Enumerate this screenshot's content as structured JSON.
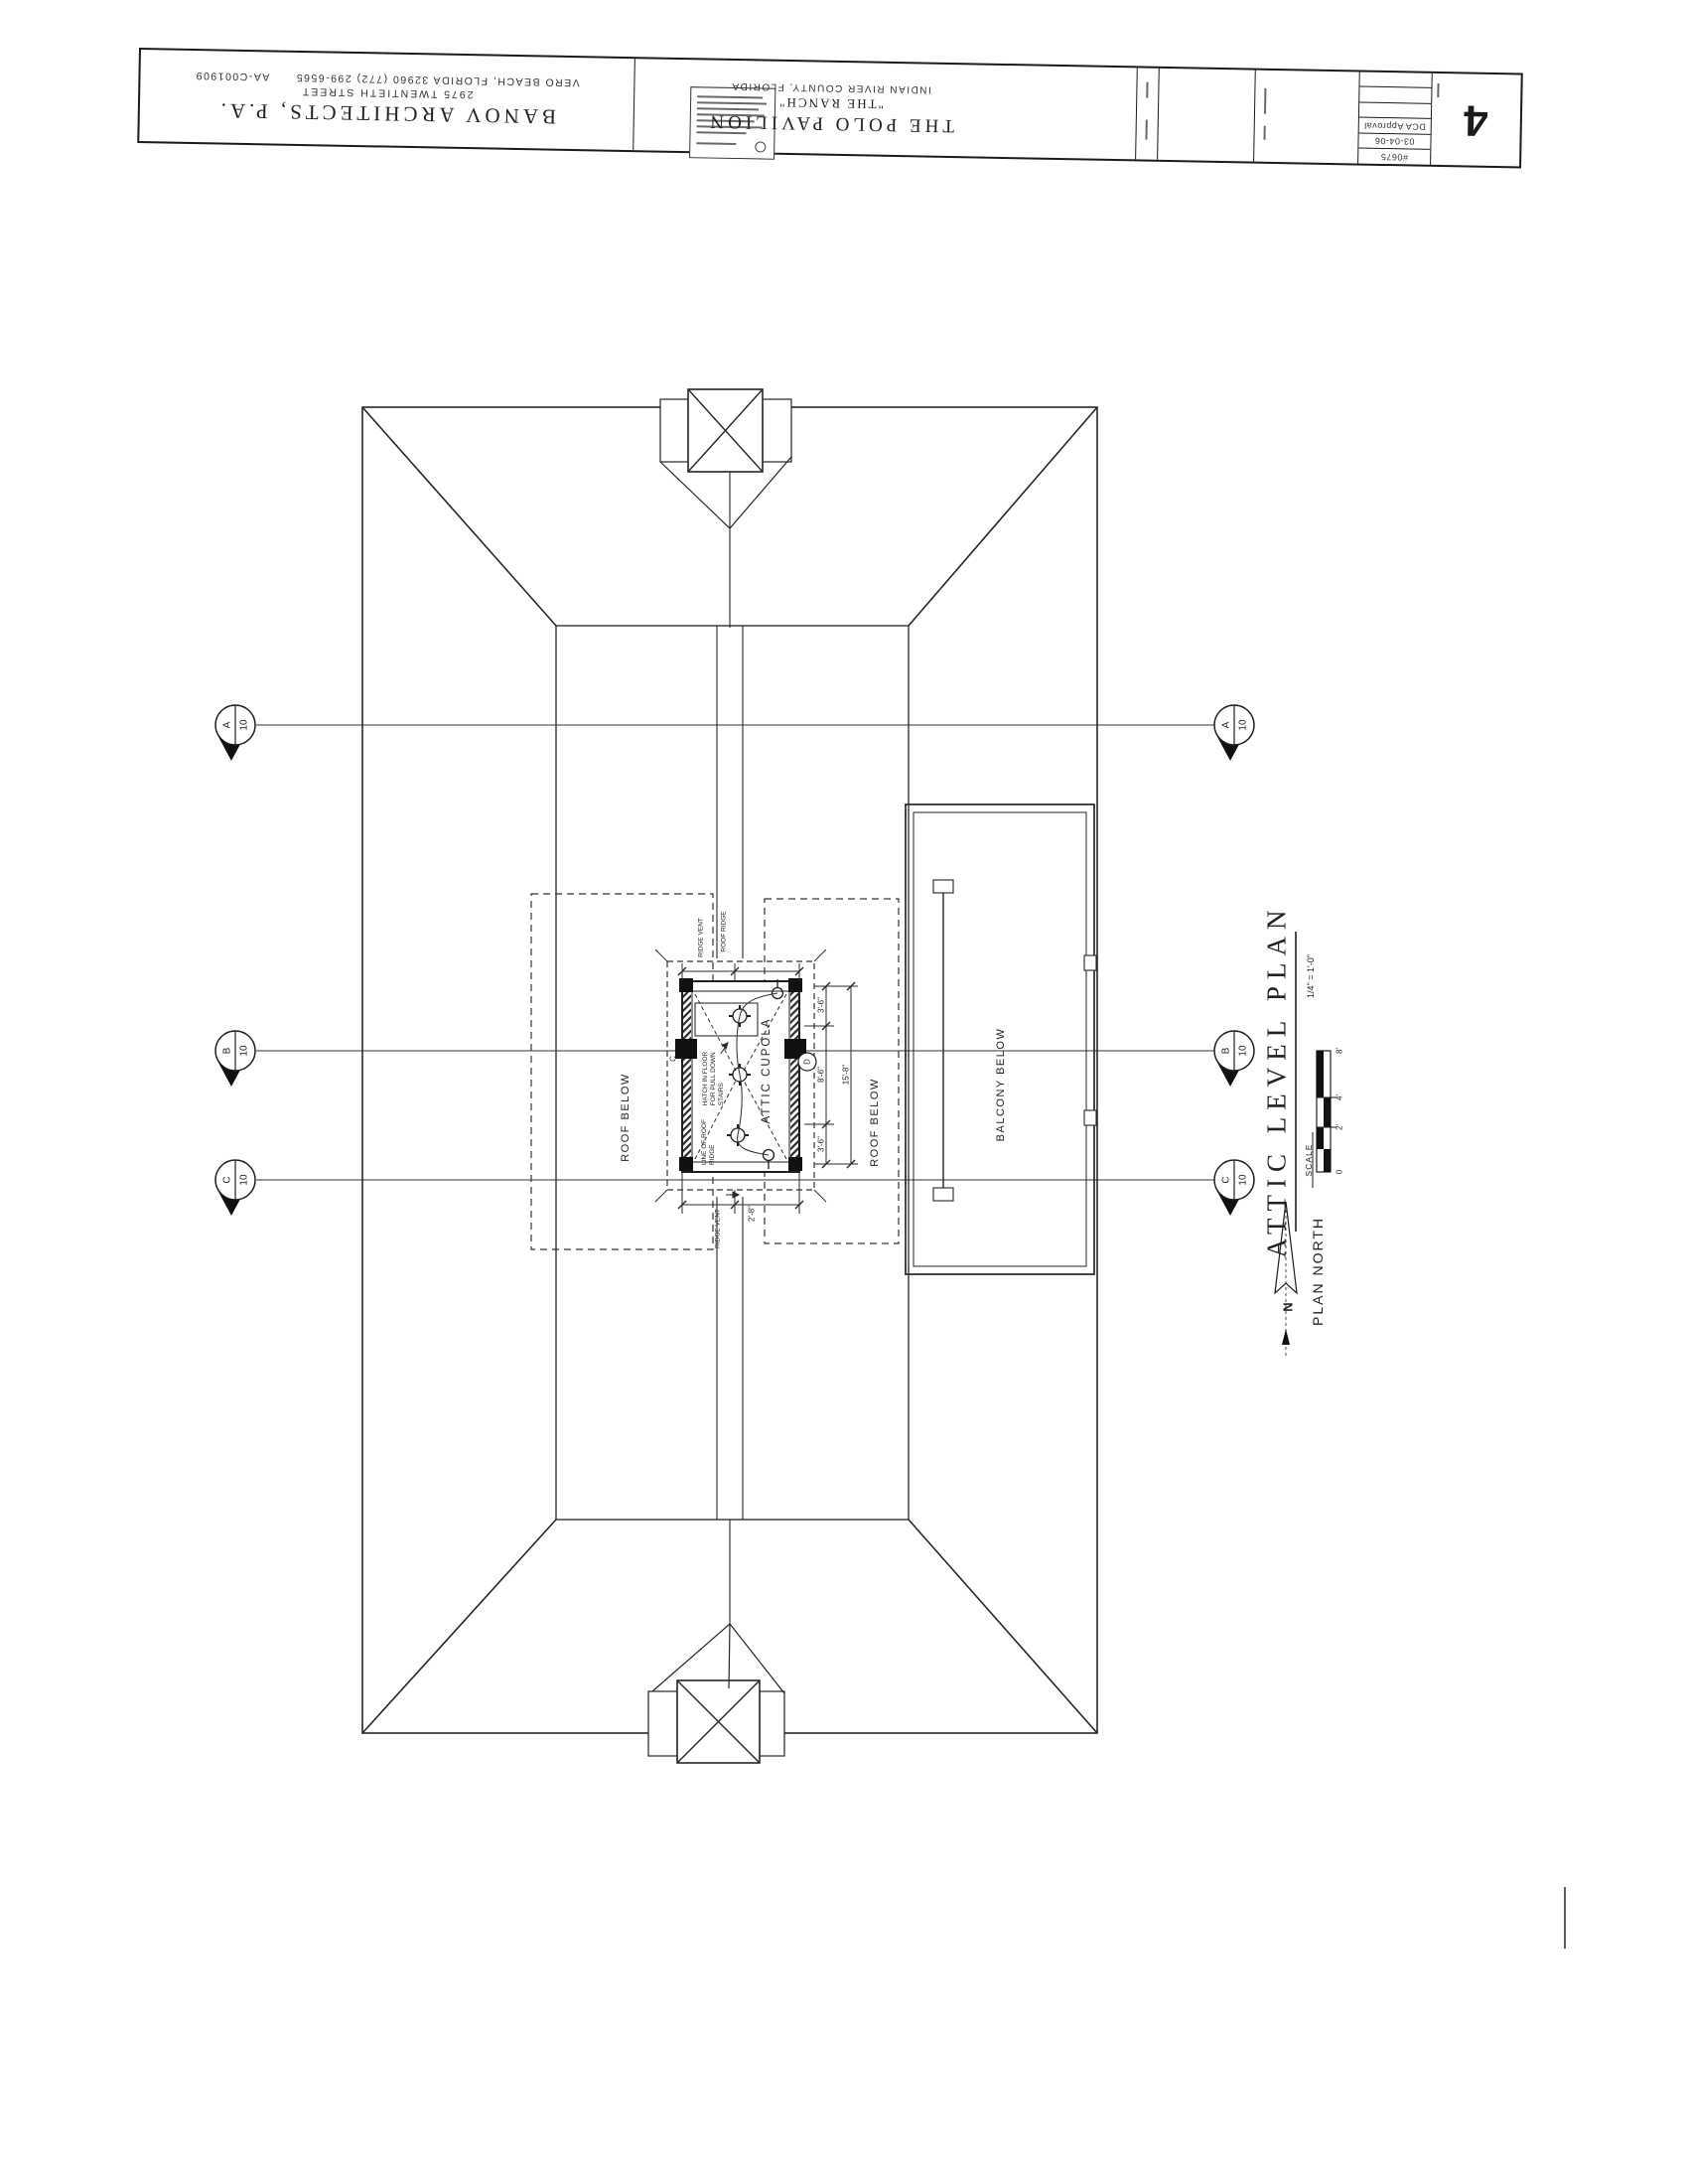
{
  "sheet": {
    "architect": {
      "name": "BANOV ARCHITECTS, P.A.",
      "street": "2975 TWENTIETH STREET",
      "city": "VERO BEACH, FLORIDA 32960 (772) 299-6565",
      "license": "AA-C001909"
    },
    "project": {
      "name": "THE POLO PAVILION",
      "alias": "\"THE RANCH\"",
      "location": "INDIAN RIVER COUNTY, FLORIDA"
    },
    "revisions": {
      "rows": [
        "#0675",
        "03-04-06",
        "DCA Approval"
      ]
    },
    "sheet_number": "4"
  },
  "plan": {
    "labels": {
      "roof_below_left": "ROOF BELOW",
      "roof_below_right": "ROOF BELOW",
      "balcony_below": "BALCONY BELOW",
      "attic_cupola": "ATTIC CUPOLA",
      "grid_c": "C",
      "detail_d": "D"
    },
    "notes": {
      "hatch_line1": "HATCH IN FLOOR",
      "hatch_line2": "FOR PULL DOWN",
      "hatch_line3": "STAIRS",
      "ridge_note_line1": "LINE OF ROOF",
      "ridge_note_line2": "RIDGE",
      "ridge_vent_top": "RIDGE VENT",
      "roof_ridge_top": "ROOF RIDGE",
      "ridge_vent_bottom": "RIDGE VENT"
    },
    "dimensions": {
      "right_top": "3'-6\"",
      "right_middle": "8'-6\"",
      "right_bottom": "3'-6\"",
      "right_overall": "15'-8\"",
      "bottom": "2'-8\""
    },
    "section_markers": [
      {
        "letter": "A",
        "sheet": "10"
      },
      {
        "letter": "B",
        "sheet": "10"
      },
      {
        "letter": "C",
        "sheet": "10"
      }
    ]
  },
  "titlebar": {
    "title": "ATTIC LEVEL PLAN",
    "scale_label": "SCALE",
    "scale_value": "1/4\" = 1'-0\"",
    "scale_ticks": [
      "0",
      "2'",
      "4'",
      "8'"
    ],
    "north_label": "PLAN NORTH",
    "north_letter": "N"
  }
}
